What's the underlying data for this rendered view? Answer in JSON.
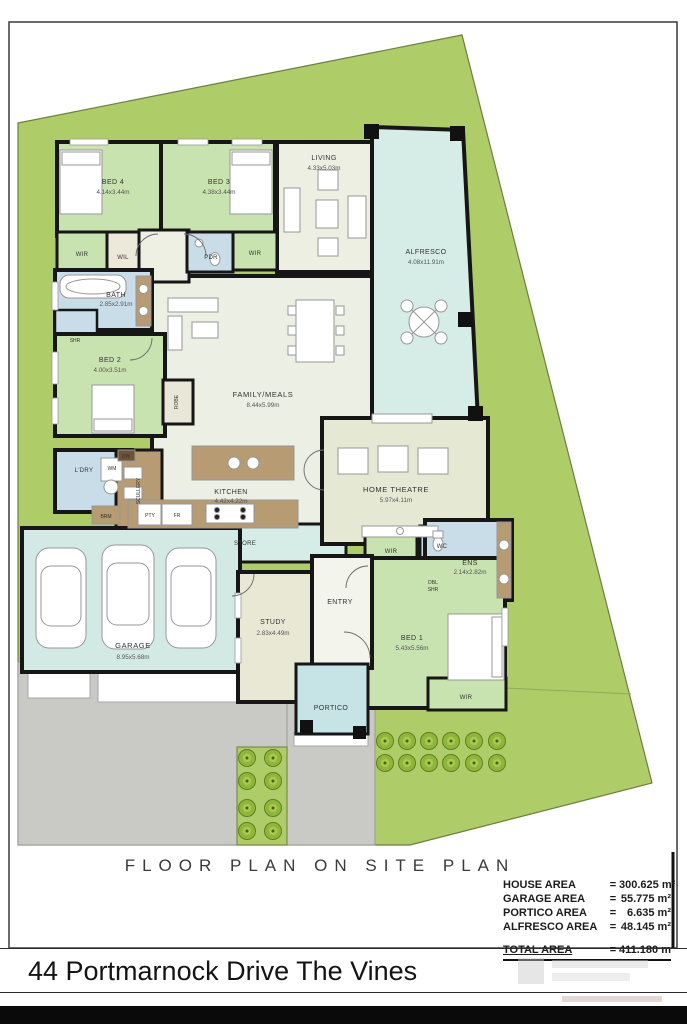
{
  "page": {
    "plan_caption": "FLOOR PLAN ON SITE PLAN",
    "address": "44 Portmarnock Drive The Vines"
  },
  "area_table": {
    "rows": [
      {
        "label": "HOUSE AREA",
        "eq": "=",
        "value": "300.625 m²"
      },
      {
        "label": "GARAGE AREA",
        "eq": "=",
        "value": "55.775 m²"
      },
      {
        "label": "PORTICO AREA",
        "eq": "=",
        "value": "6.635 m²"
      },
      {
        "label": "ALFRESCO AREA",
        "eq": "=",
        "value": "48.145 m²"
      }
    ],
    "total": {
      "label": "TOTAL AREA",
      "eq": "=",
      "value": "411.180 m²"
    }
  },
  "rooms": {
    "bed4": {
      "name": "BED 4",
      "dims": "4.14x3.44m"
    },
    "bed3": {
      "name": "BED 3",
      "dims": "4.38x3.44m"
    },
    "living": {
      "name": "LIVING",
      "dims": "4.33x5.03m"
    },
    "alfresco": {
      "name": "ALFRESCO",
      "dims": "4.08x11.91m"
    },
    "bath": {
      "name": "BATH",
      "dims": "2.85x2.91m"
    },
    "bed2": {
      "name": "BED 2",
      "dims": "4.00x3.51m"
    },
    "family": {
      "name": "FAMILY/MEALS",
      "dims": "8.44x5.99m"
    },
    "kitchen": {
      "name": "KITCHEN",
      "dims": "4.42x4.22m"
    },
    "theatre": {
      "name": "HOME THEATRE",
      "dims": "5.97x4.11m"
    },
    "ens": {
      "name": "ENS",
      "dims": "2.14x2.82m"
    },
    "bed1": {
      "name": "BED 1",
      "dims": "5.43x5.56m"
    },
    "garage": {
      "name": "GARAGE",
      "dims": "8.95x5.68m"
    },
    "study": {
      "name": "STUDY",
      "dims": "2.83x4.49m"
    }
  },
  "labels": {
    "wir": "WIR",
    "wil": "WIL",
    "pdr": "PDR",
    "shr": "SHR",
    "dbl": "DBL",
    "robe": "ROBE",
    "scullery": "SCULLERY",
    "ldry": "L'DRY",
    "wm": "WM",
    "dw": "DW",
    "brm": "BRM",
    "pty": "PTY",
    "fr": "FR",
    "store": "STORE",
    "wc": "WC",
    "entry": "ENTRY",
    "portico": "PORTICO"
  },
  "colors": {
    "site_green": "#aecd69",
    "bedroom_green": "#c8e3af",
    "outdoor_cyan": "#d6ece7",
    "wet_blue": "#c9dde9",
    "living_ivory": "#edefe3",
    "theatre_ivory": "#e5e8d3",
    "tile_brown": "#b79b73",
    "driveway_gray": "#c9c9c6",
    "wall_black": "#161616",
    "tree_green": "#8fb63a"
  }
}
